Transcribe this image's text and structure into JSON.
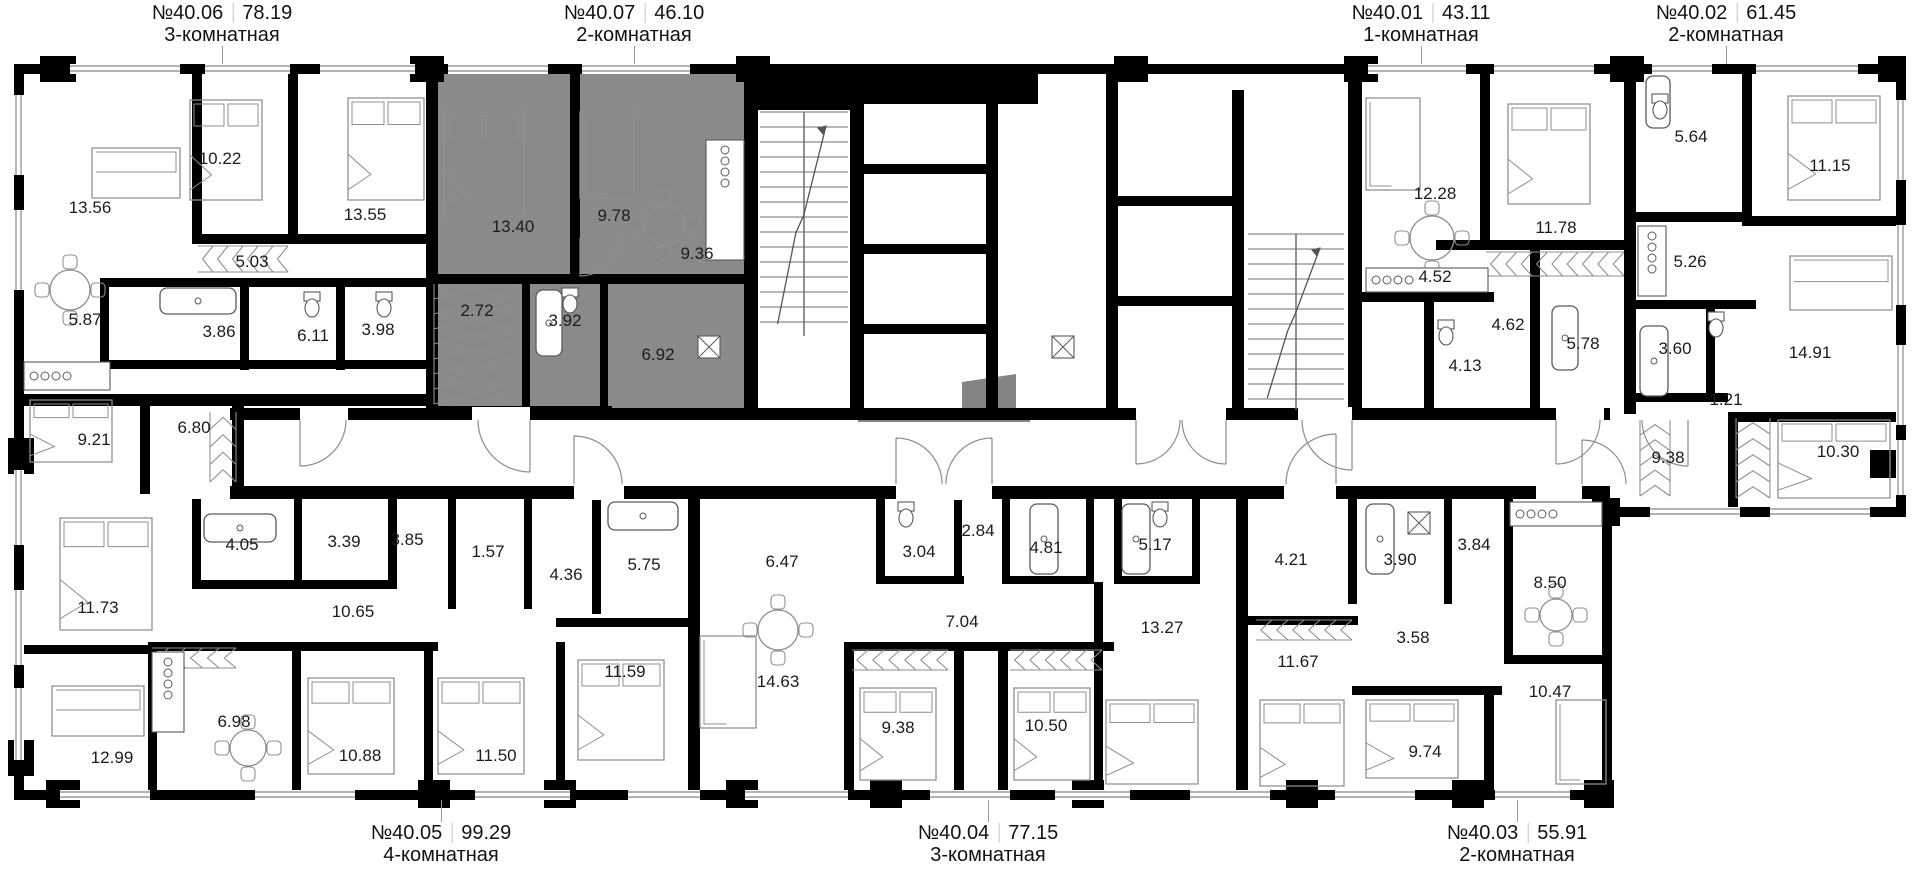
{
  "plan": {
    "title_note": "floor plan level with apartments",
    "colors": {
      "wall": "#000000",
      "highlight": "#8a8a8a",
      "furniture": "#8f8f8f",
      "fixture": "#5a5a5a",
      "window": "#9a9a9a",
      "door": "#8c8c8c",
      "text": "#1c1c1c"
    },
    "apartments": [
      {
        "id": "40.06",
        "number": "№40.06",
        "total_area": "78.19",
        "type": "3-комнатная",
        "label_side": "top",
        "label_x": 222,
        "highlighted": false,
        "rooms": [
          {
            "area": "13.56",
            "x": 90,
            "y": 208
          },
          {
            "area": "10.22",
            "x": 220,
            "y": 159
          },
          {
            "area": "13.55",
            "x": 365,
            "y": 215
          },
          {
            "area": "5.03",
            "x": 252,
            "y": 262
          },
          {
            "area": "5.87",
            "x": 85,
            "y": 320
          },
          {
            "area": "3.86",
            "x": 219,
            "y": 332
          },
          {
            "area": "6.11",
            "x": 313,
            "y": 336
          },
          {
            "area": "3.98",
            "x": 378,
            "y": 330
          },
          {
            "area": "9.21",
            "x": 94,
            "y": 440
          },
          {
            "area": "6.80",
            "x": 194,
            "y": 428
          }
        ]
      },
      {
        "id": "40.07",
        "number": "№40.07",
        "total_area": "46.10",
        "type": "2-комнатная",
        "label_side": "top",
        "label_x": 634,
        "highlighted": true,
        "rooms": [
          {
            "area": "13.40",
            "x": 513,
            "y": 227
          },
          {
            "area": "9.78",
            "x": 614,
            "y": 216
          },
          {
            "area": "9.36",
            "x": 697,
            "y": 254
          },
          {
            "area": "2.72",
            "x": 477,
            "y": 311
          },
          {
            "area": "3.92",
            "x": 565,
            "y": 321
          },
          {
            "area": "6.92",
            "x": 658,
            "y": 355
          }
        ]
      },
      {
        "id": "40.01",
        "number": "№40.01",
        "total_area": "43.11",
        "type": "1-комнатная",
        "label_side": "top",
        "label_x": 1421,
        "highlighted": false,
        "rooms": [
          {
            "area": "12.28",
            "x": 1435,
            "y": 194
          },
          {
            "area": "4.52",
            "x": 1435,
            "y": 277
          },
          {
            "area": "11.78",
            "x": 1556,
            "y": 228
          },
          {
            "area": "4.62",
            "x": 1508,
            "y": 325
          },
          {
            "area": "4.13",
            "x": 1465,
            "y": 366
          },
          {
            "area": "5.78",
            "x": 1583,
            "y": 344
          }
        ]
      },
      {
        "id": "40.02",
        "number": "№40.02",
        "total_area": "61.45",
        "type": "2-комнатная",
        "label_side": "top",
        "label_x": 1726,
        "highlighted": false,
        "rooms": [
          {
            "area": "5.64",
            "x": 1691,
            "y": 137
          },
          {
            "area": "11.15",
            "x": 1830,
            "y": 166
          },
          {
            "area": "5.26",
            "x": 1690,
            "y": 262
          },
          {
            "area": "3.60",
            "x": 1675,
            "y": 349
          },
          {
            "area": "14.91",
            "x": 1810,
            "y": 353
          },
          {
            "area": "1.21",
            "x": 1726,
            "y": 400
          },
          {
            "area": "9.38",
            "x": 1668,
            "y": 458
          },
          {
            "area": "10.30",
            "x": 1838,
            "y": 452
          }
        ]
      },
      {
        "id": "40.05",
        "number": "№40.05",
        "total_area": "99.29",
        "type": "4-комнатная",
        "label_side": "bottom",
        "label_x": 441,
        "highlighted": false,
        "rooms": [
          {
            "area": "11.73",
            "x": 98,
            "y": 608
          },
          {
            "area": "4.05",
            "x": 242,
            "y": 545
          },
          {
            "area": "3.39",
            "x": 344,
            "y": 542
          },
          {
            "area": "3.85",
            "x": 407,
            "y": 540
          },
          {
            "area": "10.65",
            "x": 353,
            "y": 612
          },
          {
            "area": "1.57",
            "x": 488,
            "y": 552
          },
          {
            "area": "4.36",
            "x": 566,
            "y": 575
          },
          {
            "area": "5.75",
            "x": 644,
            "y": 565
          },
          {
            "area": "11.59",
            "x": 625,
            "y": 672
          },
          {
            "area": "12.99",
            "x": 112,
            "y": 758
          },
          {
            "area": "6.98",
            "x": 234,
            "y": 722
          },
          {
            "area": "10.88",
            "x": 360,
            "y": 756
          },
          {
            "area": "11.50",
            "x": 496,
            "y": 756
          }
        ]
      },
      {
        "id": "40.04",
        "number": "№40.04",
        "total_area": "77.15",
        "type": "3-комнатная",
        "label_side": "bottom",
        "label_x": 988,
        "highlighted": false,
        "rooms": [
          {
            "area": "6.47",
            "x": 782,
            "y": 562
          },
          {
            "area": "3.04",
            "x": 919,
            "y": 552
          },
          {
            "area": "2.84",
            "x": 978,
            "y": 531
          },
          {
            "area": "4.81",
            "x": 1046,
            "y": 548
          },
          {
            "area": "5.17",
            "x": 1155,
            "y": 545
          },
          {
            "area": "7.04",
            "x": 962,
            "y": 622
          },
          {
            "area": "13.27",
            "x": 1162,
            "y": 628
          },
          {
            "area": "14.63",
            "x": 778,
            "y": 682
          },
          {
            "area": "9.38",
            "x": 898,
            "y": 728
          },
          {
            "area": "10.50",
            "x": 1046,
            "y": 726
          }
        ]
      },
      {
        "id": "40.03",
        "number": "№40.03",
        "total_area": "55.91",
        "type": "2-комнатная",
        "label_side": "bottom",
        "label_x": 1517,
        "highlighted": false,
        "rooms": [
          {
            "area": "4.21",
            "x": 1291,
            "y": 560
          },
          {
            "area": "3.90",
            "x": 1400,
            "y": 560
          },
          {
            "area": "3.84",
            "x": 1474,
            "y": 545
          },
          {
            "area": "3.58",
            "x": 1413,
            "y": 638
          },
          {
            "area": "11.67",
            "x": 1298,
            "y": 662
          },
          {
            "area": "8.50",
            "x": 1550,
            "y": 583
          },
          {
            "area": "9.74",
            "x": 1425,
            "y": 752
          },
          {
            "area": "10.47",
            "x": 1550,
            "y": 692
          }
        ]
      }
    ]
  }
}
